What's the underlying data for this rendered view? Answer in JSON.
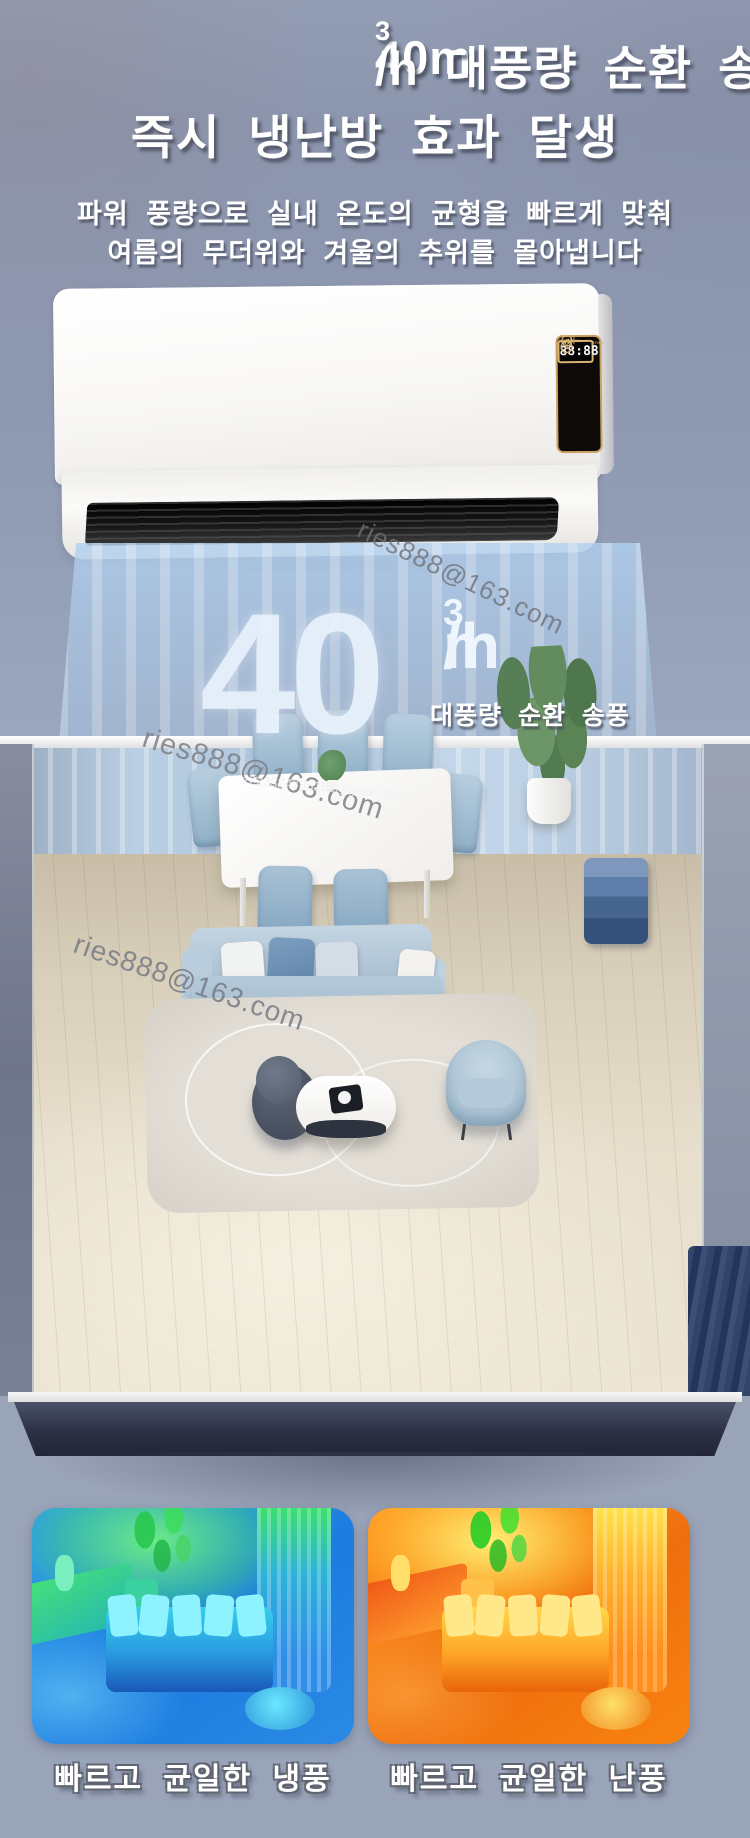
{
  "header": {
    "title_line1": {
      "pre": "40m",
      "sup": "3",
      "post": "/h 대풍량 순환 송풍"
    },
    "title_line2": "즉시 냉난방 효과 달생",
    "subtitle_line1": "파워 풍량으로 실내 온도의 균형을 빠르게 맞춰",
    "subtitle_line2": "여름의 무더위와 겨울의 추위를 몰아냅니다"
  },
  "ac_unit": {
    "panel": {
      "brand_text": "Power Cold&Warm Timing",
      "display_value": "88:88",
      "minus_label": "−",
      "plus_label": "+",
      "mode_icon_label": "%",
      "button_labels": [
        "TIMER",
        "COLD/WARM",
        "ON/OFF"
      ]
    }
  },
  "airflow": {
    "value": "40",
    "unit_pre": "m",
    "unit_sup": "3",
    "unit_post": "/h",
    "caption": "대풍량 순환 송풍"
  },
  "watermarks": [
    {
      "text": "ries888@163.com"
    },
    {
      "text": "ries888@163.com"
    },
    {
      "text": "z223324785155@gmail.com"
    },
    {
      "text": "ries888@163.com"
    }
  ],
  "comparison": {
    "left_caption": "빠르고 균일한 냉풍",
    "right_caption": "빠르고 균일한 난풍"
  },
  "colors": {
    "background_top": "#8e99b1",
    "background_bottom": "#9aa4b9",
    "panel_gold": "#d8b273",
    "vent_black": "#161616",
    "air_blue": "#b0cfee",
    "cold_primary": "#1d7ce0",
    "cold_accent": "#46e86a",
    "warm_primary": "#f57812",
    "warm_accent": "#ffd84a",
    "caption_text": "#ffffff"
  }
}
